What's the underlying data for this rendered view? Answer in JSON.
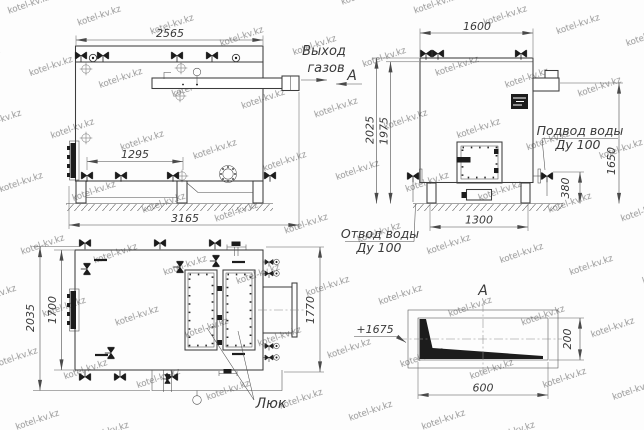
{
  "watermark": {
    "text": "kotel-kv.kz"
  },
  "side_view": {
    "dim_top_width": "2565",
    "dim_bottom_valves": "1295",
    "dim_total_length": "3165",
    "gas_outlet_line1": "Выход",
    "gas_outlet_line2": "газов",
    "section_arrow_label": "А"
  },
  "front_view": {
    "dim_width": "1600",
    "dim_height_overall": "2025",
    "dim_height_body": "1975",
    "dim_inlet_height": "1650",
    "dim_valve_height": "380",
    "dim_base_width": "1300",
    "water_inlet_line1": "Подвод воды",
    "water_inlet_line2": "Ду 100",
    "water_outlet_line1": "Отвод воды",
    "water_outlet_line2": "Ду 100"
  },
  "plan_view": {
    "dim_depth_overall": "2035",
    "dim_depth_body": "1700",
    "dim_depth_right": "1770",
    "hatch_label": "Люк"
  },
  "section_view": {
    "title": "А",
    "elevation_mark": "+1675",
    "dim_height": "200",
    "dim_width": "600"
  }
}
